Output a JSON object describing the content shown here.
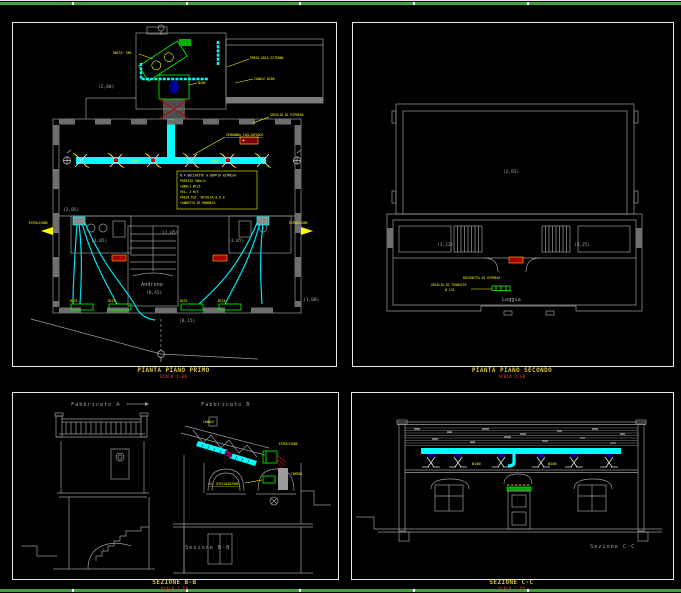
{
  "colors": {
    "background": "#000000",
    "frame": "#e8e8e8",
    "border_green": "#3fa23f",
    "duct_cyan": "#00ffff",
    "annotation_yellow": "#ffff00",
    "grille_green": "#00ff00",
    "alert_red": "#b00000",
    "wall_gray": "#9c9c9c",
    "title_yellow": "#d8c24a",
    "scale_red": "#c03030"
  },
  "titles": {
    "p1": {
      "title": "PIANTA PIANO PRIMO",
      "scale": "SCALA 1:50"
    },
    "p2": {
      "title": "PIANTA PIANO SECONDO",
      "scale": "SCALA 1:50"
    },
    "p3": {
      "title": "SEZIONE B-B",
      "scale": "SCALA 1:50"
    },
    "p4": {
      "title": "SEZIONE C-C",
      "scale": "SCALA 1:50"
    }
  },
  "p1": {
    "rooms": {
      "wing": "(2,00)",
      "left_top": "(2,05)",
      "left": "(3,05)",
      "right": "(3,05)",
      "hall": "(2,05)",
      "androne": "Androne",
      "androne_q": "(0,45)",
      "floor_q": "(0,15)",
      "right_q": "(1,00)"
    },
    "legend": [
      "N.4 BOCCHETTE A DOPPIA RIPRESA",
      "PORTATA 50mc/h",
      "CANALI Ø125",
      "VEL. 2 M/S",
      "PRESA EST. GRIGLIA 0,5 m",
      "CONDOTTO DI MANDATA"
    ],
    "ann": {
      "presa": "PRESA ARIA ESTERNA",
      "canale": "CANALE Ø200",
      "d200a": "Ø200",
      "d200b": "Ø200",
      "d200c": "Ø200",
      "vmc": "UNITA' VMC",
      "serranda": "SERRANDA TAGLIAFUOCO",
      "griglia": "GRIGLIA DI RIPRESA",
      "espulsione1": "ESPULSIONE",
      "espulsione2": "ESPULSIONE",
      "g1": "Ø125",
      "g2": "Ø125",
      "g3": "Ø125",
      "g4": "Ø125"
    }
  },
  "p2": {
    "rooms": {
      "big": "(2,65)",
      "left": "(3,23)",
      "right": "(3,25)",
      "loggia": "Loggia"
    },
    "ann": {
      "bocchetta": "BOCCHETTA DI RIPRESA",
      "griglia": "GRIGLIA DI TRANSITO",
      "diam": "Ø 125"
    }
  },
  "p3": {
    "fab_a": "Fabbricato A",
    "fab_b": "Fabbricato B",
    "caption": "Sezione B-B",
    "ann": {
      "canale": "CANALE",
      "espulsione": "ESPULSIONE",
      "camino": "CAMINO",
      "unita": "EL. RISCALDATORE"
    }
  },
  "p4": {
    "caption": "Sezione C-C",
    "ann": {
      "d1": "Ø100",
      "d2": "Ø100"
    }
  }
}
